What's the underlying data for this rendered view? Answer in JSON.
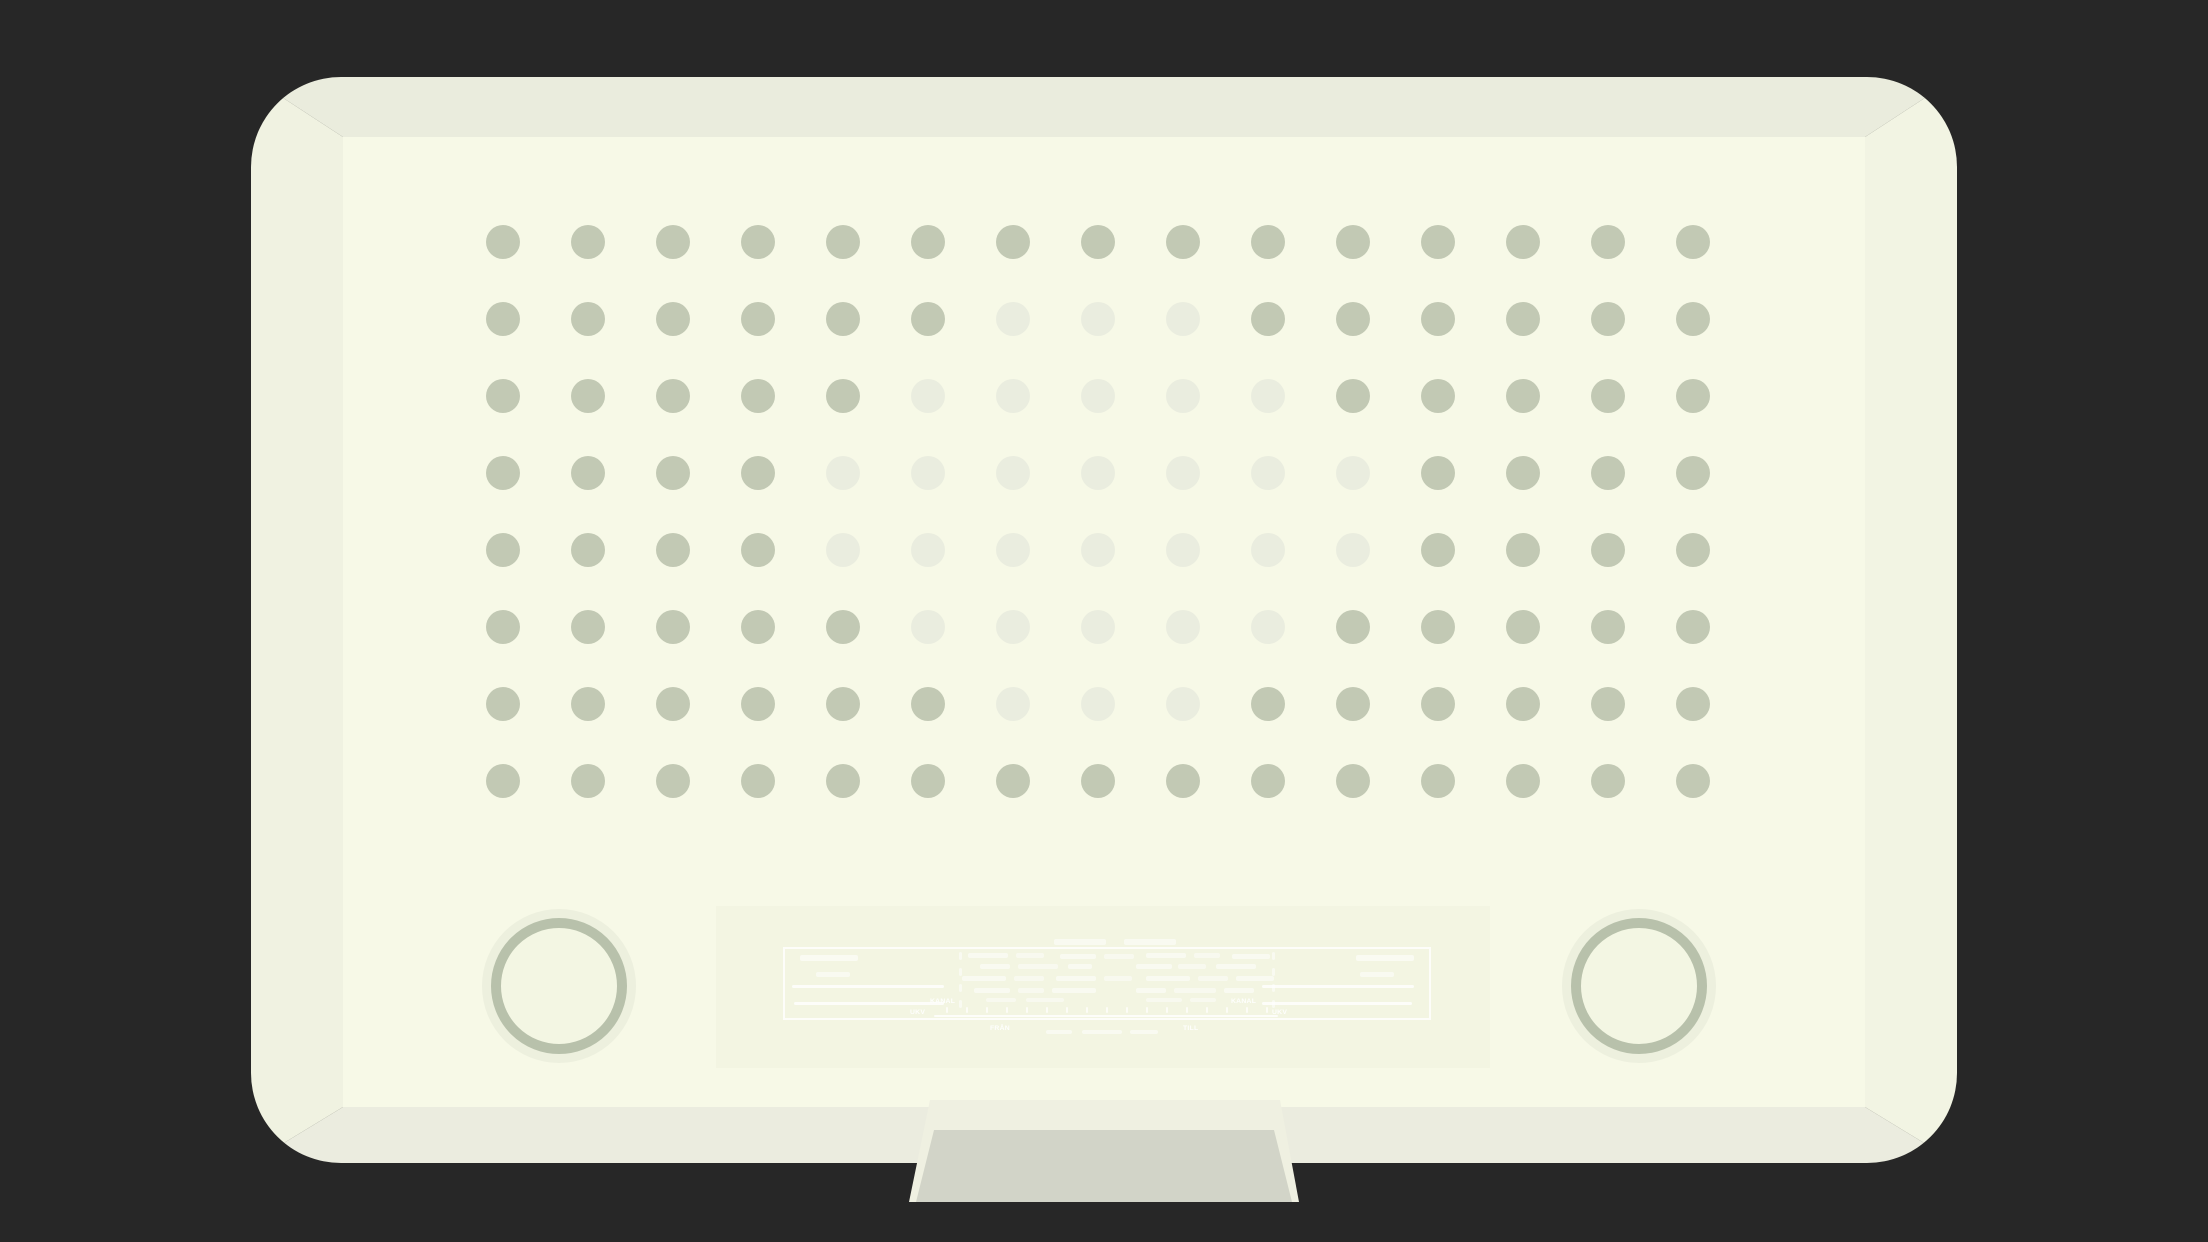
{
  "colors": {
    "bg": "#272727",
    "frame_top": "#eaecdd",
    "frame_right": "#f2f4e3",
    "frame_bottom": "#ebecdf",
    "frame_left": "#f0f2e1",
    "face": "#f7f9e7",
    "dot_dark": "#c2c9b4",
    "dot_faded": "#eaeddf",
    "knob_halo": "#edf0de",
    "knob_ring": "#b8c1ab",
    "knob_fill": "#f3f6e3",
    "panel": "#f3f5e2",
    "stand_light": "#eff0e1",
    "stand_dark": "#d2d4c8",
    "marking": "#ffffff"
  },
  "speaker_grille": {
    "rows": 8,
    "cols": 15,
    "legend": "1 = dark dot, 0 = faded dot",
    "pattern": [
      "111111111111111",
      "111111000111111",
      "111110000011111",
      "111100000001111",
      "111100000001111",
      "111110000011111",
      "111111000111111",
      "111111111111111"
    ]
  },
  "dial": {
    "labels": [
      {
        "text": "KANAL",
        "x": 214,
        "y": 92
      },
      {
        "text": "KANAL",
        "x": 515,
        "y": 92
      },
      {
        "text": "UKV",
        "x": 194,
        "y": 103
      },
      {
        "text": "UKV",
        "x": 556,
        "y": 103
      },
      {
        "text": "FRÅN",
        "x": 274,
        "y": 119
      },
      {
        "text": "TILL",
        "x": 467,
        "y": 119
      }
    ],
    "marks": {
      "rects": [
        {
          "x": 338,
          "y": 33,
          "w": 52,
          "h": 6,
          "o": 0.5
        },
        {
          "x": 408,
          "y": 33,
          "w": 52,
          "h": 6,
          "o": 0.5
        },
        {
          "x": 84,
          "y": 49,
          "w": 58,
          "h": 6,
          "o": 0.55
        },
        {
          "x": 640,
          "y": 49,
          "w": 58,
          "h": 6,
          "o": 0.55
        },
        {
          "x": 100,
          "y": 66,
          "w": 34,
          "h": 5,
          "o": 0.5
        },
        {
          "x": 644,
          "y": 66,
          "w": 34,
          "h": 5,
          "o": 0.5
        },
        {
          "x": 76,
          "y": 79,
          "w": 152,
          "h": 3,
          "o": 0.8
        },
        {
          "x": 546,
          "y": 79,
          "w": 152,
          "h": 3,
          "o": 0.8
        },
        {
          "x": 78,
          "y": 96,
          "w": 150,
          "h": 3,
          "o": 0.8
        },
        {
          "x": 546,
          "y": 96,
          "w": 150,
          "h": 3,
          "o": 0.8
        },
        {
          "x": 252,
          "y": 47,
          "w": 40,
          "h": 5,
          "o": 0.5
        },
        {
          "x": 300,
          "y": 47,
          "w": 28,
          "h": 5,
          "o": 0.45
        },
        {
          "x": 344,
          "y": 48,
          "w": 36,
          "h": 5,
          "o": 0.5
        },
        {
          "x": 388,
          "y": 48,
          "w": 30,
          "h": 5,
          "o": 0.45
        },
        {
          "x": 430,
          "y": 47,
          "w": 40,
          "h": 5,
          "o": 0.5
        },
        {
          "x": 478,
          "y": 47,
          "w": 26,
          "h": 5,
          "o": 0.45
        },
        {
          "x": 516,
          "y": 48,
          "w": 38,
          "h": 5,
          "o": 0.5
        },
        {
          "x": 264,
          "y": 58,
          "w": 30,
          "h": 5,
          "o": 0.5
        },
        {
          "x": 302,
          "y": 58,
          "w": 40,
          "h": 5,
          "o": 0.45
        },
        {
          "x": 352,
          "y": 58,
          "w": 24,
          "h": 5,
          "o": 0.5
        },
        {
          "x": 420,
          "y": 58,
          "w": 36,
          "h": 5,
          "o": 0.5
        },
        {
          "x": 462,
          "y": 58,
          "w": 28,
          "h": 5,
          "o": 0.45
        },
        {
          "x": 500,
          "y": 58,
          "w": 40,
          "h": 5,
          "o": 0.5
        },
        {
          "x": 246,
          "y": 70,
          "w": 44,
          "h": 5,
          "o": 0.5
        },
        {
          "x": 298,
          "y": 70,
          "w": 30,
          "h": 5,
          "o": 0.45
        },
        {
          "x": 340,
          "y": 70,
          "w": 40,
          "h": 5,
          "o": 0.5
        },
        {
          "x": 388,
          "y": 70,
          "w": 28,
          "h": 5,
          "o": 0.45
        },
        {
          "x": 430,
          "y": 70,
          "w": 44,
          "h": 5,
          "o": 0.5
        },
        {
          "x": 482,
          "y": 70,
          "w": 30,
          "h": 5,
          "o": 0.45
        },
        {
          "x": 520,
          "y": 70,
          "w": 38,
          "h": 5,
          "o": 0.5
        },
        {
          "x": 258,
          "y": 82,
          "w": 36,
          "h": 5,
          "o": 0.5
        },
        {
          "x": 302,
          "y": 82,
          "w": 26,
          "h": 5,
          "o": 0.45
        },
        {
          "x": 336,
          "y": 82,
          "w": 44,
          "h": 5,
          "o": 0.5
        },
        {
          "x": 420,
          "y": 82,
          "w": 30,
          "h": 5,
          "o": 0.5
        },
        {
          "x": 458,
          "y": 82,
          "w": 42,
          "h": 5,
          "o": 0.45
        },
        {
          "x": 508,
          "y": 82,
          "w": 30,
          "h": 5,
          "o": 0.5
        },
        {
          "x": 270,
          "y": 92,
          "w": 30,
          "h": 4,
          "o": 0.45
        },
        {
          "x": 310,
          "y": 92,
          "w": 38,
          "h": 4,
          "o": 0.45
        },
        {
          "x": 430,
          "y": 92,
          "w": 36,
          "h": 4,
          "o": 0.45
        },
        {
          "x": 474,
          "y": 92,
          "w": 26,
          "h": 4,
          "o": 0.45
        },
        {
          "x": 243,
          "y": 46,
          "w": 3,
          "h": 8,
          "o": 0.5
        },
        {
          "x": 243,
          "y": 62,
          "w": 3,
          "h": 8,
          "o": 0.5
        },
        {
          "x": 243,
          "y": 78,
          "w": 3,
          "h": 8,
          "o": 0.5
        },
        {
          "x": 243,
          "y": 94,
          "w": 3,
          "h": 8,
          "o": 0.5
        },
        {
          "x": 556,
          "y": 46,
          "w": 3,
          "h": 8,
          "o": 0.5
        },
        {
          "x": 556,
          "y": 62,
          "w": 3,
          "h": 8,
          "o": 0.5
        },
        {
          "x": 556,
          "y": 78,
          "w": 3,
          "h": 8,
          "o": 0.5
        },
        {
          "x": 556,
          "y": 94,
          "w": 3,
          "h": 8,
          "o": 0.5
        },
        {
          "x": 218,
          "y": 109,
          "w": 344,
          "h": 2,
          "o": 0.8
        },
        {
          "x": 330,
          "y": 124,
          "w": 26,
          "h": 4,
          "o": 0.5
        },
        {
          "x": 366,
          "y": 124,
          "w": 40,
          "h": 4,
          "o": 0.5
        },
        {
          "x": 414,
          "y": 124,
          "w": 28,
          "h": 4,
          "o": 0.5
        }
      ],
      "tick_row": {
        "x_start": 230,
        "x_end": 550,
        "step": 20,
        "y": 101,
        "w": 2,
        "h": 6,
        "o": 0.7
      }
    }
  }
}
